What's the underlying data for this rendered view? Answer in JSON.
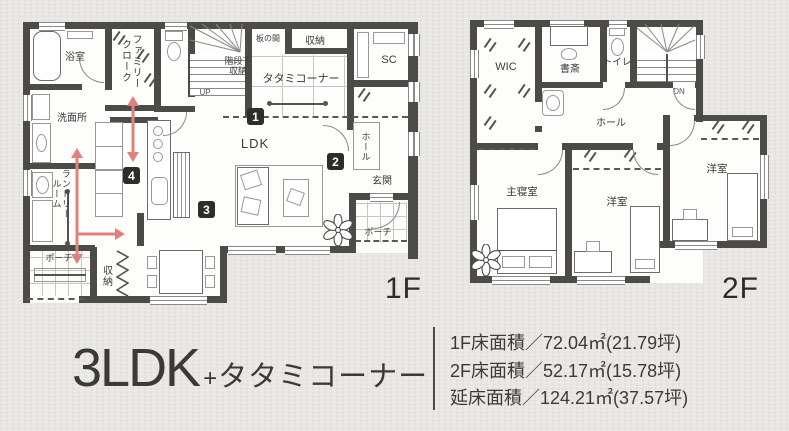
{
  "colors": {
    "background": "#e9e7e3",
    "wall": "#4d4b47",
    "accent_arrow": "#e2817b",
    "badge_bg": "#2e2d2b",
    "text": "#3a3a3a"
  },
  "icons": {
    "flower": "flower-decoration",
    "flow_arrow": "traffic-flow-arrow"
  },
  "floor1": {
    "floor_label": "1F",
    "labels": {
      "bath": "浴室",
      "family_cloak": "ファミリークローク",
      "washroom": "洗面所",
      "laundry_room": "ランドリールーム",
      "porch_left": "ポーチ",
      "storage_bottom": "収納",
      "ldk": "LDK",
      "tatami_corner": "タタミコーナー",
      "itanoma": "板の間",
      "storage_top": "収納",
      "shoe_closet": "SC",
      "under_stairs_line1": "階段下",
      "under_stairs_line2": "収納",
      "up": "UP",
      "hall": "ホール",
      "entrance": "玄関",
      "porch_right": "ポーチ"
    },
    "badges": [
      "1",
      "2",
      "3",
      "4"
    ]
  },
  "floor2": {
    "floor_label": "2F",
    "labels": {
      "wic": "WIC",
      "study": "書斎",
      "toilet": "トイレ",
      "down": "DN",
      "hall": "ホール",
      "master_bedroom": "主寝室",
      "bedroom_center": "洋室",
      "bedroom_right": "洋室"
    }
  },
  "summary": {
    "plan_type": "3LDK",
    "plan_plus": "+",
    "plan_suffix": "タタミコーナー",
    "area_lines": [
      "1F床面積／72.04㎡(21.79坪)",
      "2F床面積／52.17㎡(15.78坪)",
      "延床面積／124.21㎡(37.57坪)"
    ]
  }
}
